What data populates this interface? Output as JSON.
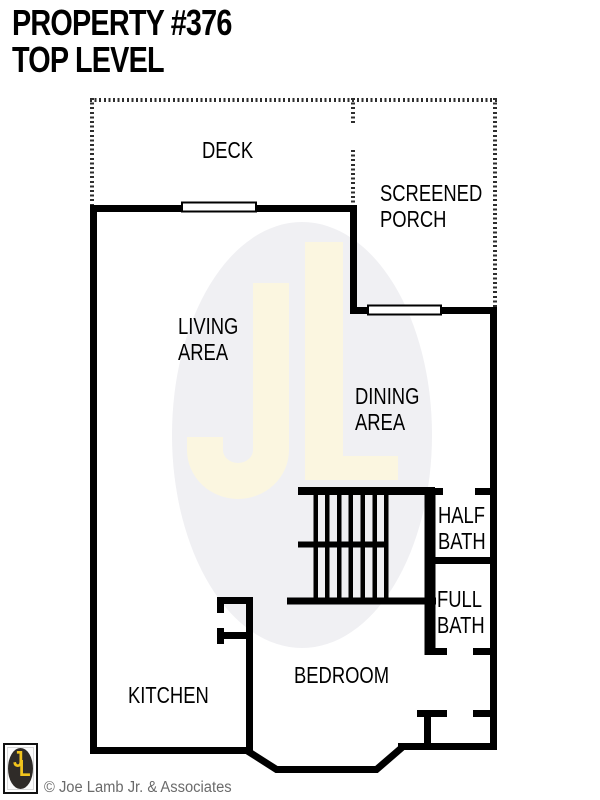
{
  "title": {
    "line1": "PROPERTY #376",
    "line2": "TOP LEVEL"
  },
  "rooms": {
    "deck": {
      "label": "DECK"
    },
    "screened_porch": {
      "line1": "SCREENED",
      "line2": "PORCH"
    },
    "living_area": {
      "line1": "LIVING",
      "line2": "AREA"
    },
    "dining_area": {
      "line1": "DINING",
      "line2": "AREA"
    },
    "half_bath": {
      "line1": "HALF",
      "line2": "BATH"
    },
    "full_bath": {
      "line1": "FULL",
      "line2": "BATH"
    },
    "kitchen": {
      "label": "KITCHEN"
    },
    "bedroom": {
      "label": "BEDROOM"
    }
  },
  "watermark": {
    "monogram": "JL"
  },
  "logo": {
    "letter_j": "J",
    "letter_l": "L"
  },
  "footer": {
    "copyright": "© Joe Lamb Jr. & Associates"
  },
  "colors": {
    "wall": "#000000",
    "deck_dotted": "#2e2e2e",
    "watermark_oval": "#f0f0f3",
    "watermark_monogram": "#fbf6e0",
    "logo_gold": "#f2c41d",
    "logo_oval": "#2f2b28",
    "copyright_text": "#6b6b6b"
  }
}
